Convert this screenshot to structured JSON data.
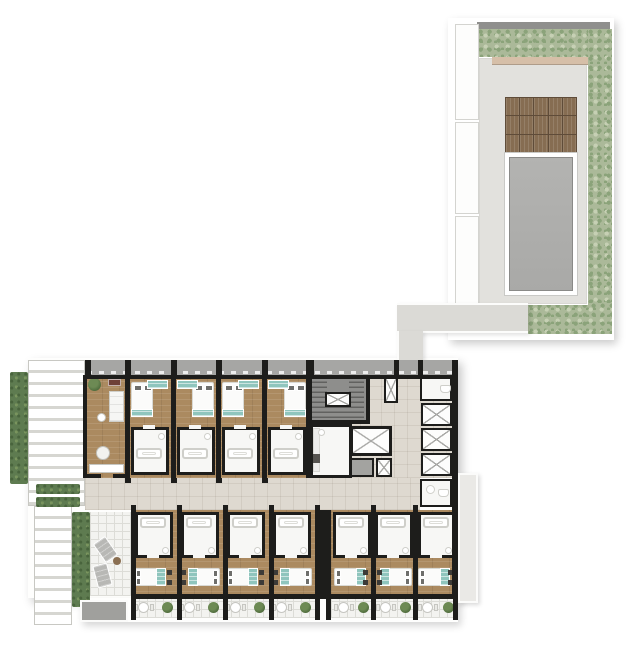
{
  "palette": {
    "wall": "#1d1d1b",
    "wood": "#ab8a60",
    "corridor": "#ded9d0",
    "bath": "#f7f7f5",
    "fixture": "#cfcfca",
    "teal": "#8fc5bd",
    "hedge": "#5e7b50",
    "hedge_dot": "#49643d",
    "hedge_light": "#79945e",
    "landscape": "#abb999",
    "landscape_dot": "#8ba37a",
    "landscape_light": "#c6d0b4",
    "deck": "#e2e1dd",
    "deck_wood": "#866d52",
    "deck_wood_gap": "#5f4c39",
    "water": "#a9a9a7",
    "water_light": "#b3b3b1",
    "stair": "#8e8e8c",
    "tread": "#61615f",
    "ledge": "#a6a6a4",
    "slat": "#ffffff",
    "slat_gap": "#d6d6d1",
    "tile": "#f3f3f0",
    "tile_line": "#dcdcd7",
    "tan": "#d6bfa8",
    "lounger": "#b8b8b5",
    "plant": "#4e6b3c",
    "plant_light": "#6d8a54",
    "pad": "#a0a09d",
    "annex": "#eae9e6",
    "xline": "#a9a9a6",
    "pillow": "#6e6e6b",
    "bedframe": "#d9d9d4",
    "bed": "#fbfbfa",
    "maroon": "#6e4038",
    "table_wood": "#8a6f52",
    "walk": "#dbdad6"
  },
  "plan_inventory": {
    "pools": 1,
    "pool_walkway_segments": 3,
    "wood_deck_grid": {
      "cols": 5,
      "rows": 3
    },
    "top_row_guestrooms": 4,
    "bottom_row_guestrooms": 7,
    "balconies": 7,
    "side_elevator_shafts": 3,
    "main_elevators": 1,
    "stair_cores": 1,
    "terrace_loungers": 2,
    "planter_strips": 2,
    "lounge_rooms": 1,
    "terraces": 1
  }
}
